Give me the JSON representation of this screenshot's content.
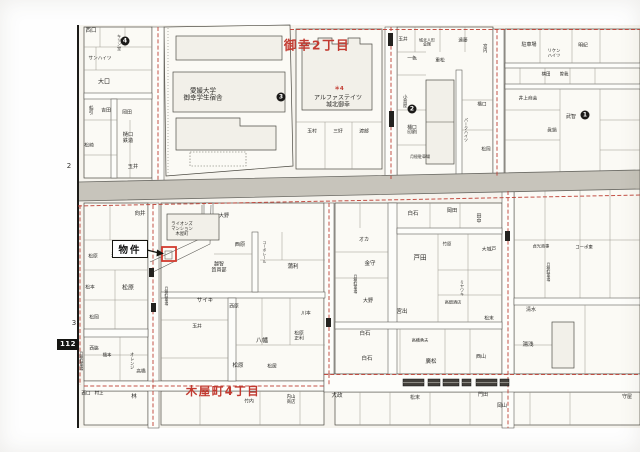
{
  "map_title": "住宅地図",
  "colors": {
    "paper": "#f6f4ee",
    "block_fill": "#fbfaf5",
    "road_gray": "#c7c4bb",
    "boundary_red": "#bf4338",
    "district_red": "#c23a30",
    "property_red": "#d23b2f"
  },
  "districts": [
    {
      "text": "御幸2丁目",
      "x": 317,
      "y": 44,
      "size": 12.5
    },
    {
      "text": "木屋町4丁目",
      "x": 223,
      "y": 391,
      "size": 11.5
    }
  ],
  "property_callout": {
    "label": "物件"
  },
  "sheet_marks": {
    "left_upper": "2",
    "left_lower": "3",
    "sheet_number": "112"
  },
  "legend_note": {
    "text": "＊4",
    "x": 339,
    "y": 88
  },
  "markers": [
    {
      "n": "1",
      "x": 585,
      "y": 115
    },
    {
      "n": "2",
      "x": 412,
      "y": 109
    },
    {
      "n": "3",
      "x": 281,
      "y": 97
    },
    {
      "n": "4",
      "x": 125,
      "y": 41
    }
  ],
  "labels": [
    {
      "t": "西口",
      "x": 91,
      "y": 31,
      "s": 5.5
    },
    {
      "t": "キリン堂",
      "x": 119,
      "y": 42,
      "s": 4.2,
      "v": 1
    },
    {
      "t": "サンハイツ",
      "x": 100,
      "y": 59,
      "s": 4.6
    },
    {
      "t": "大口",
      "x": 104,
      "y": 83,
      "s": 6
    },
    {
      "t": "船引",
      "x": 90,
      "y": 110,
      "s": 4.6,
      "v": 1
    },
    {
      "t": "吉田",
      "x": 106,
      "y": 111,
      "s": 4.8
    },
    {
      "t": "岡田",
      "x": 127,
      "y": 113,
      "s": 4.8
    },
    {
      "t": "樋口\n鉄造",
      "x": 128,
      "y": 139,
      "s": 5.2
    },
    {
      "t": "松崎",
      "x": 89,
      "y": 146,
      "s": 4.8
    },
    {
      "t": "玉井",
      "x": 133,
      "y": 168,
      "s": 5.2
    },
    {
      "t": "愛媛大学\n御幸学生宿舎",
      "x": 203,
      "y": 95,
      "s": 6.5
    },
    {
      "t": "アルファステイツ\n城北御幸",
      "x": 338,
      "y": 102,
      "s": 6
    },
    {
      "t": "玉村",
      "x": 312,
      "y": 132,
      "s": 4.8
    },
    {
      "t": "三好",
      "x": 338,
      "y": 132,
      "s": 4.8
    },
    {
      "t": "渡部",
      "x": 364,
      "y": 132,
      "s": 4.8
    },
    {
      "t": "玉井",
      "x": 403,
      "y": 40,
      "s": 4.6
    },
    {
      "t": "城北人形\n会館",
      "x": 427,
      "y": 43,
      "s": 4
    },
    {
      "t": "遠藤",
      "x": 463,
      "y": 41,
      "s": 4.6
    },
    {
      "t": "宮内",
      "x": 484,
      "y": 48,
      "s": 4.4,
      "v": 1
    },
    {
      "t": "一色",
      "x": 412,
      "y": 59,
      "s": 4.8
    },
    {
      "t": "重松",
      "x": 440,
      "y": 61,
      "s": 4.8
    },
    {
      "t": "小島屋",
      "x": 404,
      "y": 101,
      "s": 4.4,
      "v": 1
    },
    {
      "t": "樋口\n印刷",
      "x": 412,
      "y": 131,
      "s": 4.8
    },
    {
      "t": "月極駐車場",
      "x": 420,
      "y": 157,
      "s": 4
    },
    {
      "t": "パークハイツ",
      "x": 466,
      "y": 130,
      "s": 4,
      "v": 1
    },
    {
      "t": "橋口",
      "x": 482,
      "y": 105,
      "s": 4.6
    },
    {
      "t": "松岡",
      "x": 486,
      "y": 150,
      "s": 4.6
    },
    {
      "t": "駐車場",
      "x": 529,
      "y": 46,
      "s": 5
    },
    {
      "t": "リケン\nハイツ",
      "x": 554,
      "y": 55,
      "s": 4.3
    },
    {
      "t": "明紀",
      "x": 583,
      "y": 46,
      "s": 4.8
    },
    {
      "t": "横田",
      "x": 546,
      "y": 76,
      "s": 4.4
    },
    {
      "t": "曽我",
      "x": 564,
      "y": 76,
      "s": 4.4
    },
    {
      "t": "井上商会",
      "x": 528,
      "y": 99,
      "s": 4.7
    },
    {
      "t": "武智",
      "x": 571,
      "y": 118,
      "s": 5
    },
    {
      "t": "眞鍋",
      "x": 552,
      "y": 131,
      "s": 4.7
    },
    {
      "t": "向井",
      "x": 140,
      "y": 214,
      "s": 5.5
    },
    {
      "t": "津田",
      "x": 116,
      "y": 256,
      "s": 4.8
    },
    {
      "t": "松原",
      "x": 93,
      "y": 257,
      "s": 4.8
    },
    {
      "t": "松原",
      "x": 128,
      "y": 289,
      "s": 6
    },
    {
      "t": "松本",
      "x": 90,
      "y": 288,
      "s": 4.8
    },
    {
      "t": "松岡",
      "x": 94,
      "y": 318,
      "s": 4.8
    },
    {
      "t": "月極駐車場",
      "x": 82,
      "y": 361,
      "s": 3.8,
      "v": 1
    },
    {
      "t": "西脇",
      "x": 94,
      "y": 349,
      "s": 4.6
    },
    {
      "t": "橋本",
      "x": 107,
      "y": 357,
      "s": 4.4
    },
    {
      "t": "オレンジ",
      "x": 131,
      "y": 361,
      "s": 4.3,
      "v": 1
    },
    {
      "t": "高橋",
      "x": 141,
      "y": 372,
      "s": 4.6
    },
    {
      "t": "西口",
      "x": 86,
      "y": 394,
      "s": 4.6
    },
    {
      "t": "村上",
      "x": 99,
      "y": 395,
      "s": 4.4
    },
    {
      "t": "林",
      "x": 134,
      "y": 397,
      "s": 5.5
    },
    {
      "t": "ライオンズ\nマンション\n木屋町",
      "x": 182,
      "y": 230,
      "s": 4.3
    },
    {
      "t": "大野",
      "x": 224,
      "y": 217,
      "s": 5
    },
    {
      "t": "月極駐車場",
      "x": 167,
      "y": 296,
      "s": 3.8,
      "v": 1
    },
    {
      "t": "越智\n質買部",
      "x": 219,
      "y": 268,
      "s": 5
    },
    {
      "t": "西原",
      "x": 240,
      "y": 246,
      "s": 5.2
    },
    {
      "t": "コーポレール",
      "x": 265,
      "y": 252,
      "s": 3.8,
      "v": 1
    },
    {
      "t": "蒲利",
      "x": 293,
      "y": 267,
      "s": 5.5
    },
    {
      "t": "サイキ",
      "x": 205,
      "y": 301,
      "s": 5.5
    },
    {
      "t": "西原",
      "x": 234,
      "y": 307,
      "s": 4.8
    },
    {
      "t": "玉井",
      "x": 197,
      "y": 327,
      "s": 4.8
    },
    {
      "t": "川本",
      "x": 306,
      "y": 314,
      "s": 4.8
    },
    {
      "t": "八幡",
      "x": 262,
      "y": 342,
      "s": 6
    },
    {
      "t": "松原\n正利",
      "x": 299,
      "y": 337,
      "s": 4.8
    },
    {
      "t": "松原",
      "x": 238,
      "y": 366,
      "s": 5.5
    },
    {
      "t": "松居",
      "x": 272,
      "y": 367,
      "s": 4.8
    },
    {
      "t": "竹内",
      "x": 249,
      "y": 402,
      "s": 4.8
    },
    {
      "t": "内山\n商店",
      "x": 291,
      "y": 401,
      "s": 4.4
    },
    {
      "t": "オカ",
      "x": 364,
      "y": 241,
      "s": 5
    },
    {
      "t": "金守",
      "x": 370,
      "y": 264,
      "s": 5.5
    },
    {
      "t": "月極駐車場",
      "x": 356,
      "y": 284,
      "s": 3.8,
      "v": 1
    },
    {
      "t": "大野",
      "x": 368,
      "y": 302,
      "s": 5
    },
    {
      "t": "白石",
      "x": 413,
      "y": 214,
      "s": 5.5
    },
    {
      "t": "岡田",
      "x": 452,
      "y": 212,
      "s": 5.2
    },
    {
      "t": "田中",
      "x": 478,
      "y": 218,
      "s": 5,
      "v": 1
    },
    {
      "t": "大城戸",
      "x": 489,
      "y": 250,
      "s": 4.8
    },
    {
      "t": "戸田",
      "x": 420,
      "y": 258,
      "s": 6.5
    },
    {
      "t": "竹原",
      "x": 447,
      "y": 246,
      "s": 4.4
    },
    {
      "t": "ミヤワキ",
      "x": 462,
      "y": 288,
      "s": 4,
      "v": 1
    },
    {
      "t": "宮出",
      "x": 402,
      "y": 312,
      "s": 5.5
    },
    {
      "t": "高畑酒店",
      "x": 453,
      "y": 303,
      "s": 4.2
    },
    {
      "t": "松末",
      "x": 489,
      "y": 319,
      "s": 4.8
    },
    {
      "t": "白石",
      "x": 365,
      "y": 334,
      "s": 5.5
    },
    {
      "t": "白石",
      "x": 367,
      "y": 359,
      "s": 5.5
    },
    {
      "t": "高橋勇夫",
      "x": 420,
      "y": 341,
      "s": 4.2
    },
    {
      "t": "廣松",
      "x": 431,
      "y": 362,
      "s": 5.5
    },
    {
      "t": "西山",
      "x": 481,
      "y": 358,
      "s": 5
    },
    {
      "t": "貞光商事",
      "x": 541,
      "y": 247,
      "s": 4.2
    },
    {
      "t": "コーポ東",
      "x": 584,
      "y": 249,
      "s": 4.4
    },
    {
      "t": "月極駐車場",
      "x": 549,
      "y": 272,
      "s": 3.8,
      "v": 1
    },
    {
      "t": "清水",
      "x": 531,
      "y": 311,
      "s": 5
    },
    {
      "t": "湯浅",
      "x": 528,
      "y": 345,
      "s": 5.5
    },
    {
      "t": "守屋",
      "x": 627,
      "y": 398,
      "s": 5
    },
    {
      "t": "大政",
      "x": 337,
      "y": 396,
      "s": 5.5
    },
    {
      "t": "松末",
      "x": 415,
      "y": 399,
      "s": 5
    },
    {
      "t": "門田",
      "x": 483,
      "y": 396,
      "s": 5
    },
    {
      "t": "岡山",
      "x": 502,
      "y": 407,
      "s": 5
    }
  ]
}
